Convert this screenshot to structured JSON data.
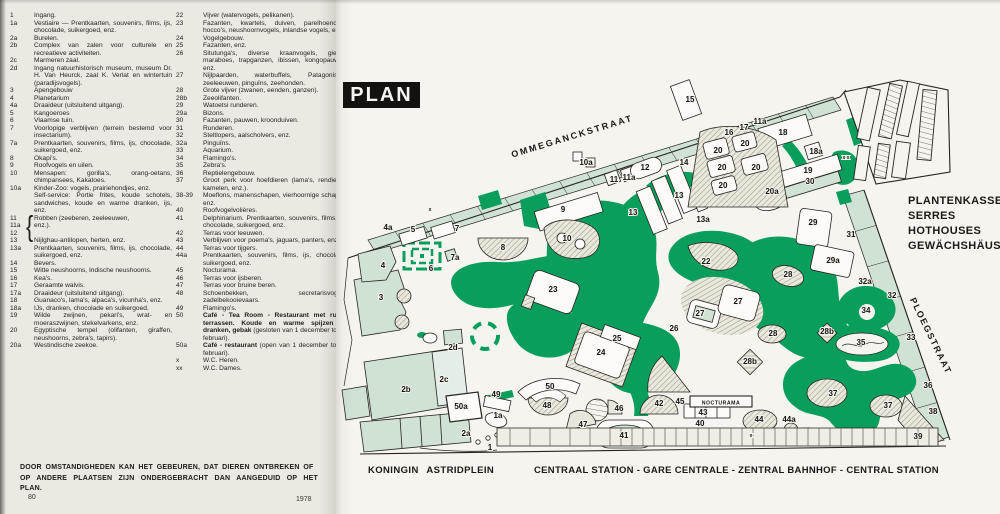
{
  "legend": {
    "brace": "{",
    "col1": [
      {
        "n": "1",
        "t": "Ingang."
      },
      {
        "n": "1a",
        "t": "Vestiaire — Prentkaarten, souvenirs, films, ijs, chocolade, suikergoed, enz."
      },
      {
        "n": "2a",
        "t": "Burelen."
      },
      {
        "n": "2b",
        "t": "Complex van zalen voor culturele en recreatieve activiteiten."
      },
      {
        "n": "2c",
        "t": "Marmeren zaal."
      },
      {
        "n": "2d",
        "t": "Ingang natuurhistorisch museum, museum Dr. H. Van Heurck, zaal K. Verlat en wintertuin (paradijsvogels)."
      },
      {
        "n": "3",
        "t": "Apengebouw"
      },
      {
        "n": "4",
        "t": "Planetarium"
      },
      {
        "n": "4a",
        "t": "Draaideur (uitsluitend uitgang)."
      },
      {
        "n": "5",
        "t": "Kangoeroes"
      },
      {
        "n": "6",
        "t": "Vlaamse tuin."
      },
      {
        "n": "7",
        "t": "Voorlopige verblijven (terrein bestemd voor insectarium)."
      },
      {
        "n": "7a",
        "t": "Prentkaarten, souvenirs, films, ijs, chocolade, suikergoed, enz."
      },
      {
        "n": "8",
        "t": "Okapi's."
      },
      {
        "n": "9",
        "t": "Roofvogels en uilen."
      },
      {
        "n": "10",
        "t": "Mensapen: gorilla's, orang-oetans, chimpansees, Kakatoes."
      },
      {
        "n": "10a",
        "t": "Kinder-Zoo: vogels, prairiehondjes, enz."
      },
      {
        "n": "",
        "t": "Self-service: Portie frites, koude schotels, sandwiches, koude en warme dranken, ijs, enz."
      },
      {
        "n": "11",
        "t": "Robben (zeeberen, zeeleeuwen,"
      },
      {
        "n": "11a",
        "t": "enz.)."
      },
      {
        "n": "12",
        "t": ""
      },
      {
        "n": "13",
        "t": "Nijlghau-antilopen, herten, enz."
      },
      {
        "n": "13a",
        "t": "Prentkaarten, souvenirs, films, ijs, chocolade, suikergoed, enz."
      },
      {
        "n": "14",
        "t": "Bevers."
      },
      {
        "n": "15",
        "t": "Witte neushoorns, Indische neushoorns."
      },
      {
        "n": "16",
        "t": "Kea's."
      },
      {
        "n": "17",
        "t": "Geraamte walvis."
      },
      {
        "n": "17a",
        "t": "Draaideur (uitsluitend uitgang)."
      },
      {
        "n": "18",
        "t": "Guanaco's, lama's, alpaca's, vicunha's, enz."
      },
      {
        "n": "18a",
        "t": "IJs, dranken, chocolade en suikergoed."
      },
      {
        "n": "19",
        "t": "Wilde zwijnen, pekari's, wrat- en moeraszwijnen, stekelvarkens, enz."
      },
      {
        "n": "20",
        "t": "Egyptische tempel (olifanten, giraffen, neushoorns, zebra's, tapirs)."
      },
      {
        "n": "20a",
        "t": "Westindische zeekoe."
      }
    ],
    "col2": [
      {
        "n": "22",
        "t": "Vijver (watervogels, pelikanen)."
      },
      {
        "n": "23",
        "t": "Fazanten, kwartels, duiven, parelhoenders, hocco's, neushoornvogels, inlandse vogels, enz."
      },
      {
        "n": "24",
        "t": "Vogelgebouw."
      },
      {
        "n": "25",
        "t": "Fazanten, enz."
      },
      {
        "n": "26",
        "t": "Situtunga's, diverse kraanvogels, gieren, maraboes, trapganzen, ibissen, kongopauwen, enz."
      },
      {
        "n": "27",
        "t": "Nijlpaarden, waterbuffels, Patagonische zeeleeuwen, pinguïns, zeehonden."
      },
      {
        "n": "28",
        "t": "Grote vijver (zwanen, eenden, ganzen)."
      },
      {
        "n": "28b",
        "t": "Zeeolifanten."
      },
      {
        "n": "29",
        "t": "Watoetsi runderen."
      },
      {
        "n": "29a",
        "t": "Bizons."
      },
      {
        "n": "30",
        "t": "Fazanten, pauwen, kroonduiven."
      },
      {
        "n": "31",
        "t": "Runderen."
      },
      {
        "n": "32",
        "t": "Steltlopers, aalscholvers, enz."
      },
      {
        "n": "32a",
        "t": "Pinguïns."
      },
      {
        "n": "33",
        "t": "Aquarium."
      },
      {
        "n": "34",
        "t": "Flamingo's."
      },
      {
        "n": "35",
        "t": "Zebra's."
      },
      {
        "n": "36",
        "t": "Reptielengebouw."
      },
      {
        "n": "37",
        "t": "Groot perk voor hoefdieren (lama's, rendieren, kamelen, enz.)."
      },
      {
        "n": "38-39",
        "t": "Moeflons, manenschapen, vierhoornige schapen, enz."
      },
      {
        "n": "40",
        "t": "Roofvogelvolières."
      },
      {
        "n": "41",
        "t": "Delphinarium. Prentkaarten, souvenirs, films, ijs, chocolade, suikergoed, enz."
      },
      {
        "n": "42",
        "t": "Terras voor leeuwen."
      },
      {
        "n": "43",
        "t": "Verblijven voor poema's, jaguars, panters, enz."
      },
      {
        "n": "44",
        "t": "Terras voor tijgers."
      },
      {
        "n": "44a",
        "t": "Prentkaarten, souvenirs, films, ijs, chocolade, suikergoed, enz."
      },
      {
        "n": "45",
        "t": "Nocturama."
      },
      {
        "n": "46",
        "t": "Terras voor ijsberen."
      },
      {
        "n": "47",
        "t": "Terras voor bruine beren."
      },
      {
        "n": "48",
        "t": "Schoenbekken, secretarisvogels, zadelbekooievaars."
      },
      {
        "n": "49",
        "t": "Flamingo's."
      },
      {
        "n": "50",
        "b": "Café - Tea Room - Restaurant met ruime terrassen. Koude en warme spijzen en dranken, gebak ",
        "t": "(gesloten van 1 december tot 28 februari)."
      },
      {
        "n": "50a",
        "b": "Café - restaurant ",
        "t": "(open van 1 december tot 28 februari)."
      },
      {
        "n": "x",
        "t": "W.C. Heren."
      },
      {
        "n": "xx",
        "t": "W.C. Dames."
      }
    ]
  },
  "note": [
    "DOOR OMSTANDIGHEDEN KAN HET GEBEUREN, DAT DIEREN ONTBREKEN OF",
    "OP ANDERE PLAATSEN ZIJN ONDERGEBRACHT DAN AANGEDUID OP HET PLAN."
  ],
  "page_number": "80",
  "year": "1978",
  "map": {
    "title": "PLAN",
    "streets": {
      "top": "OMMEGANCKSTRAAT",
      "right": "PLOEGSTRAAT",
      "bottom_left": "KONINGIN  ASTRIDPLEIN",
      "bottom": "CENTRAAL STATION - GARE CENTRALE - ZENTRAL BAHNHOF - CENTRAL STATION"
    },
    "greenhouse_labels": [
      "PLANTENKASSEN",
      "SERRES",
      "HOTHOUSES",
      "GEWÄCHSHÄUSER"
    ],
    "nocturama": "NOCTURAMA",
    "colors": {
      "green": "#0a9e5c",
      "light_green": "#cfe2d3",
      "paper": "#f6f4ee",
      "ink": "#1c1a16"
    },
    "labels": [
      {
        "n": "1",
        "x": 490,
        "y": 450
      },
      {
        "n": "1a",
        "x": 498,
        "y": 418
      },
      {
        "n": "2a",
        "x": 466,
        "y": 436
      },
      {
        "n": "2b",
        "x": 406,
        "y": 392
      },
      {
        "n": "2c",
        "x": 444,
        "y": 382
      },
      {
        "n": "2d",
        "x": 453,
        "y": 350
      },
      {
        "n": "3",
        "x": 381,
        "y": 300
      },
      {
        "n": "4",
        "x": 383,
        "y": 268
      },
      {
        "n": "4a",
        "x": 388,
        "y": 230
      },
      {
        "n": "5",
        "x": 413,
        "y": 232
      },
      {
        "n": "6",
        "x": 431,
        "y": 271
      },
      {
        "n": "7",
        "x": 457,
        "y": 231
      },
      {
        "n": "7a",
        "x": 455,
        "y": 260
      },
      {
        "n": "8",
        "x": 503,
        "y": 250
      },
      {
        "n": "9",
        "x": 563,
        "y": 212
      },
      {
        "n": "10",
        "x": 567,
        "y": 241
      },
      {
        "n": "10a",
        "x": 586,
        "y": 165
      },
      {
        "n": "11",
        "x": 614,
        "y": 182
      },
      {
        "n": "11a",
        "x": 629,
        "y": 180
      },
      {
        "n": "12",
        "x": 645,
        "y": 170
      },
      {
        "n": "13",
        "x": 633,
        "y": 215
      },
      {
        "n": "13",
        "x": 679,
        "y": 198
      },
      {
        "n": "13a",
        "x": 703,
        "y": 222
      },
      {
        "n": "14",
        "x": 684,
        "y": 165
      },
      {
        "n": "15",
        "x": 690,
        "y": 102
      },
      {
        "n": "16",
        "x": 729,
        "y": 135
      },
      {
        "n": "17",
        "x": 744,
        "y": 130
      },
      {
        "n": "11a",
        "x": 760,
        "y": 124
      },
      {
        "n": "18",
        "x": 783,
        "y": 135
      },
      {
        "n": "18a",
        "x": 816,
        "y": 154
      },
      {
        "n": "19",
        "x": 808,
        "y": 173
      },
      {
        "n": "30",
        "x": 810,
        "y": 184
      },
      {
        "n": "20",
        "x": 718,
        "y": 153
      },
      {
        "n": "20",
        "x": 745,
        "y": 146
      },
      {
        "n": "20",
        "x": 722,
        "y": 170
      },
      {
        "n": "20",
        "x": 756,
        "y": 170
      },
      {
        "n": "20",
        "x": 723,
        "y": 188
      },
      {
        "n": "20a",
        "x": 772,
        "y": 194
      },
      {
        "n": "22",
        "x": 706,
        "y": 264
      },
      {
        "n": "23",
        "x": 553,
        "y": 292
      },
      {
        "n": "24",
        "x": 601,
        "y": 355
      },
      {
        "n": "25",
        "x": 617,
        "y": 341
      },
      {
        "n": "26",
        "x": 674,
        "y": 331
      },
      {
        "n": "27",
        "x": 700,
        "y": 316
      },
      {
        "n": "27",
        "x": 738,
        "y": 304
      },
      {
        "n": "28",
        "x": 788,
        "y": 277
      },
      {
        "n": "28",
        "x": 773,
        "y": 336
      },
      {
        "n": "28b",
        "x": 750,
        "y": 364
      },
      {
        "n": "28b",
        "x": 827,
        "y": 334
      },
      {
        "n": "29",
        "x": 813,
        "y": 225
      },
      {
        "n": "29a",
        "x": 833,
        "y": 263
      },
      {
        "n": "31",
        "x": 851,
        "y": 237
      },
      {
        "n": "32",
        "x": 892,
        "y": 298
      },
      {
        "n": "32a",
        "x": 865,
        "y": 284
      },
      {
        "n": "33",
        "x": 911,
        "y": 340
      },
      {
        "n": "34",
        "x": 866,
        "y": 313
      },
      {
        "n": "35",
        "x": 861,
        "y": 345
      },
      {
        "n": "36",
        "x": 928,
        "y": 388
      },
      {
        "n": "37",
        "x": 833,
        "y": 396
      },
      {
        "n": "37",
        "x": 888,
        "y": 408
      },
      {
        "n": "38",
        "x": 933,
        "y": 414
      },
      {
        "n": "39",
        "x": 918,
        "y": 439
      },
      {
        "n": "40",
        "x": 700,
        "y": 426
      },
      {
        "n": "41",
        "x": 624,
        "y": 438
      },
      {
        "n": "42",
        "x": 659,
        "y": 406
      },
      {
        "n": "43",
        "x": 703,
        "y": 415
      },
      {
        "n": "44",
        "x": 759,
        "y": 422
      },
      {
        "n": "44a",
        "x": 789,
        "y": 422
      },
      {
        "n": "45",
        "x": 680,
        "y": 404
      },
      {
        "n": "46",
        "x": 619,
        "y": 411
      },
      {
        "n": "47",
        "x": 583,
        "y": 427
      },
      {
        "n": "48",
        "x": 547,
        "y": 408
      },
      {
        "n": "49",
        "x": 496,
        "y": 397
      },
      {
        "n": "50",
        "x": 550,
        "y": 389
      },
      {
        "n": "50a",
        "x": 461,
        "y": 409
      },
      {
        "n": "x",
        "x": 430,
        "y": 211,
        "s": 5
      },
      {
        "n": "x x",
        "x": 846,
        "y": 159,
        "s": 5
      },
      {
        "n": "x",
        "x": 751,
        "y": 437,
        "s": 5
      }
    ]
  }
}
